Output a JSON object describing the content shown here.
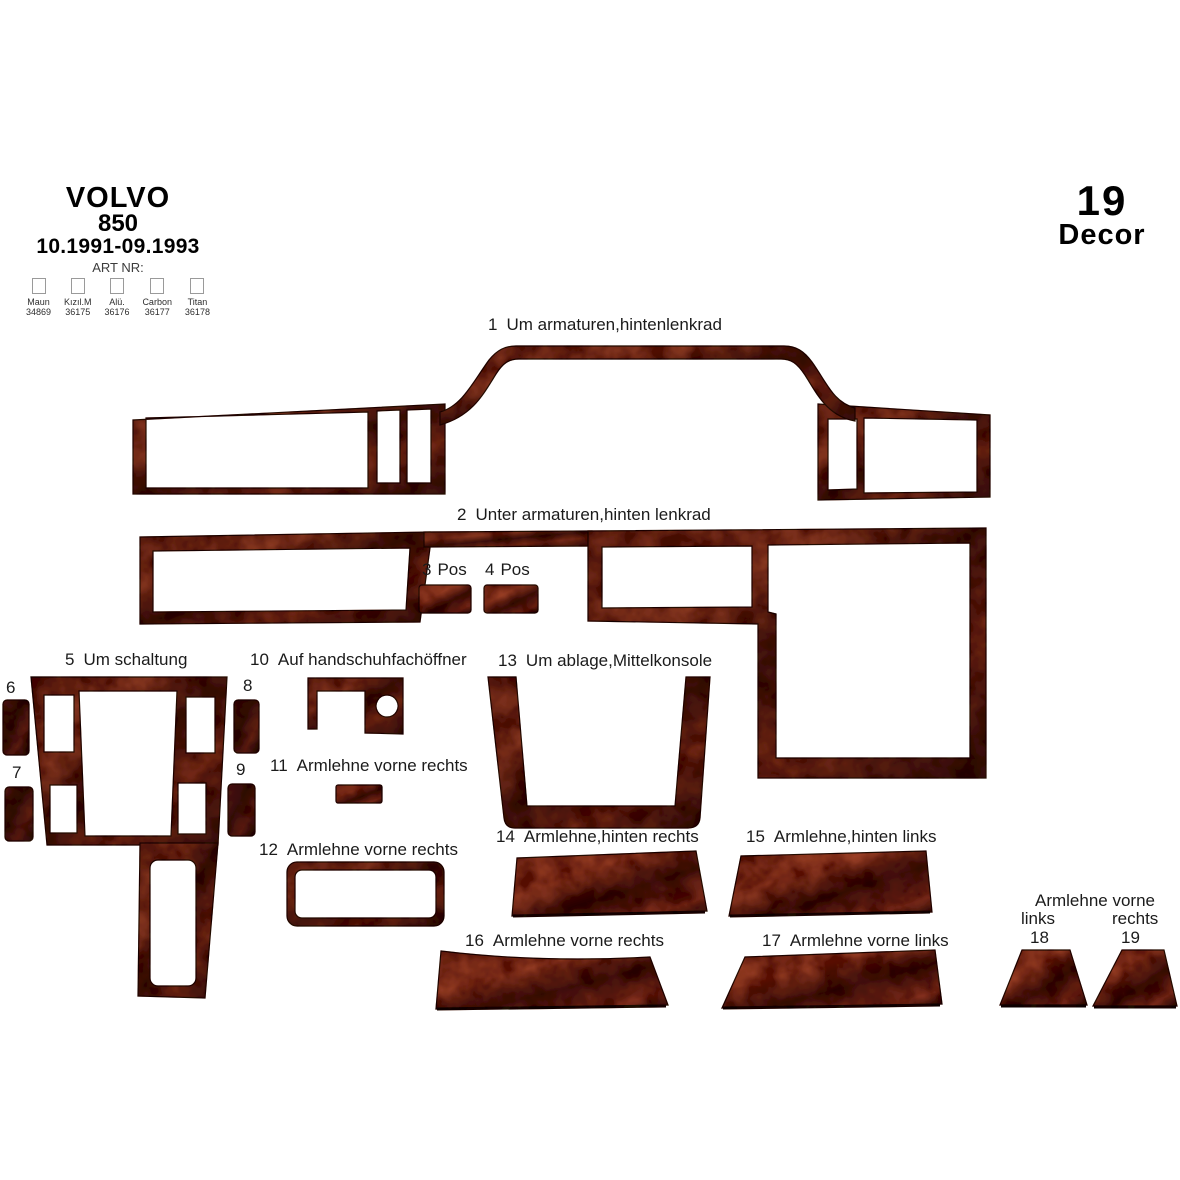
{
  "header": {
    "brand": "VOLVO",
    "model": "850",
    "years": "10.1991-09.1993",
    "art_label": "ART NR:",
    "finishes": [
      {
        "name": "Maun",
        "code": "34869"
      },
      {
        "name": "Kızıl.M",
        "code": "36175"
      },
      {
        "name": "Alü.",
        "code": "36176"
      },
      {
        "name": "Carbon",
        "code": "36177"
      },
      {
        "name": "Titan",
        "code": "36178"
      }
    ]
  },
  "badge": {
    "count": "19",
    "label": "Decor"
  },
  "parts": {
    "p1": {
      "num": "1",
      "label": "Um armaturen,hintenlenkrad"
    },
    "p2": {
      "num": "2",
      "label": "Unter armaturen,hinten lenkrad"
    },
    "p3": {
      "num": "3",
      "label": "Pos"
    },
    "p4": {
      "num": "4",
      "label": "Pos"
    },
    "p5": {
      "num": "5",
      "label": "Um schaltung"
    },
    "p6": {
      "num": "6",
      "label": ""
    },
    "p7": {
      "num": "7",
      "label": ""
    },
    "p8": {
      "num": "8",
      "label": ""
    },
    "p9": {
      "num": "9",
      "label": ""
    },
    "p10": {
      "num": "10",
      "label": "Auf handschuhfachöffner"
    },
    "p11": {
      "num": "11",
      "label": "Armlehne vorne rechts"
    },
    "p12": {
      "num": "12",
      "label": "Armlehne vorne rechts"
    },
    "p13": {
      "num": "13",
      "label": "Um ablage,Mittelkonsole"
    },
    "p14": {
      "num": "14",
      "label": "Armlehne,hinten rechts"
    },
    "p15": {
      "num": "15",
      "label": "Armlehne,hinten links"
    },
    "p16": {
      "num": "16",
      "label": "Armlehne vorne rechts"
    },
    "p17": {
      "num": "17",
      "label": "Armlehne vorne links"
    }
  },
  "group_18_19": {
    "heading": "Armlehne vorne",
    "left_label": "links",
    "right_label": "rechts",
    "left_num": "18",
    "right_num": "19"
  },
  "colors": {
    "background": "#ffffff",
    "text": "#1b1b1b",
    "wood_dark": "#38100a",
    "wood_mid": "#7b2d1a",
    "wood_light": "#9c4026"
  }
}
